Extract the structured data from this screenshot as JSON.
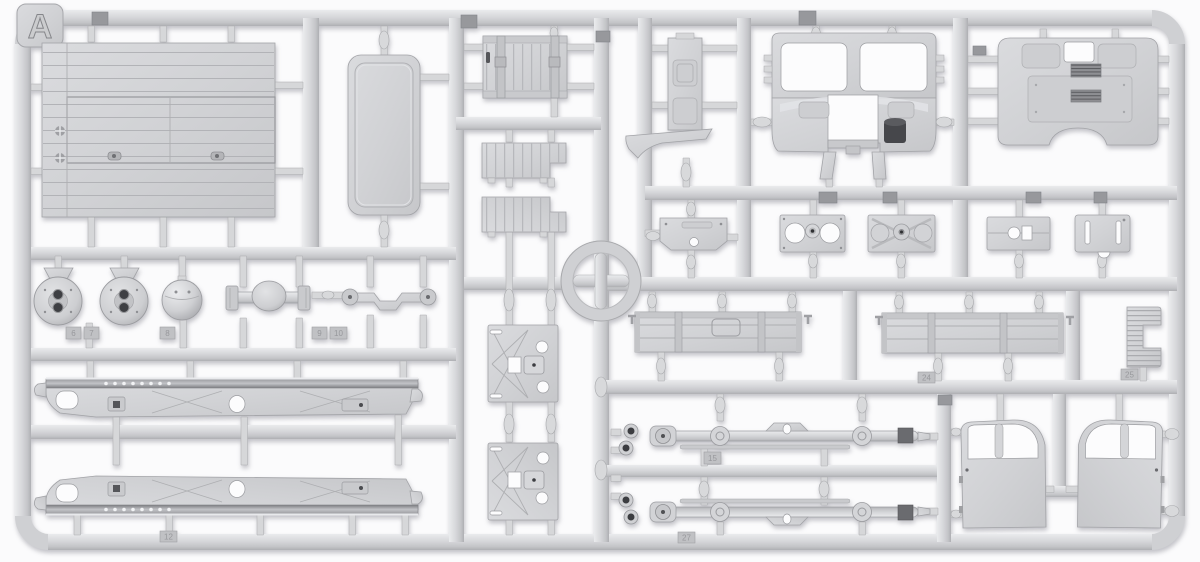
{
  "image": {
    "description": "Photograph of an injection-molded light-gray plastic model kit sprue (truck parts), frame A",
    "background_color": "#fbfbfc"
  },
  "sprue": {
    "label": "A",
    "plastic_colors": {
      "base": "#d2d3d6",
      "highlight": "#eaebed",
      "shadow": "#afb0b4",
      "recess": "#cdced1",
      "dark_detail": "#46474b"
    },
    "part_number_tags": [
      "6",
      "7",
      "8",
      "9",
      "10",
      "15",
      "24",
      "25",
      "27",
      "12"
    ],
    "parts": [
      "cargo-bed-floor",
      "cab-roof-panel",
      "tailgate",
      "running-board-upper",
      "running-board-lower",
      "firewall-panel",
      "fender-blade",
      "cab-front-windshield-panel",
      "cab-rear-panel",
      "bracket-plate-1",
      "hub-plate-2",
      "hub-plate-3",
      "mount-plate-4",
      "slotted-plate-5",
      "brake-drum-left",
      "brake-drum-right",
      "differential-sphere",
      "rear-axle",
      "front-axle",
      "chassis-rail-upper",
      "chassis-rail-lower",
      "cab-floor-panel-upper",
      "cab-floor-panel-lower",
      "bed-side-board-left",
      "bed-side-board-right",
      "c-channel-bracket",
      "leaf-spring-axle-upper",
      "leaf-spring-axle-lower",
      "cab-door-left",
      "cab-door-right",
      "sprue-ring-marker",
      "letter-tab"
    ]
  }
}
